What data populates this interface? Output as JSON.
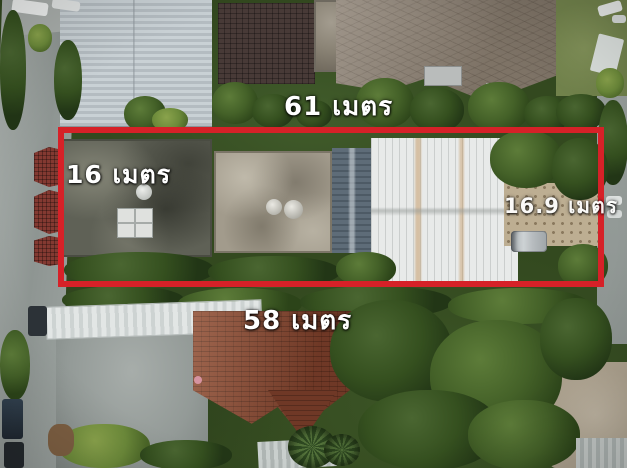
{
  "annotation": {
    "boundary_color": "#d62128",
    "label_color": "#ffffff",
    "labels": {
      "top": "61 เมตร",
      "left": "16 เมตร",
      "right": "16.9 เมตร",
      "bottom": "58 เมตร"
    }
  }
}
